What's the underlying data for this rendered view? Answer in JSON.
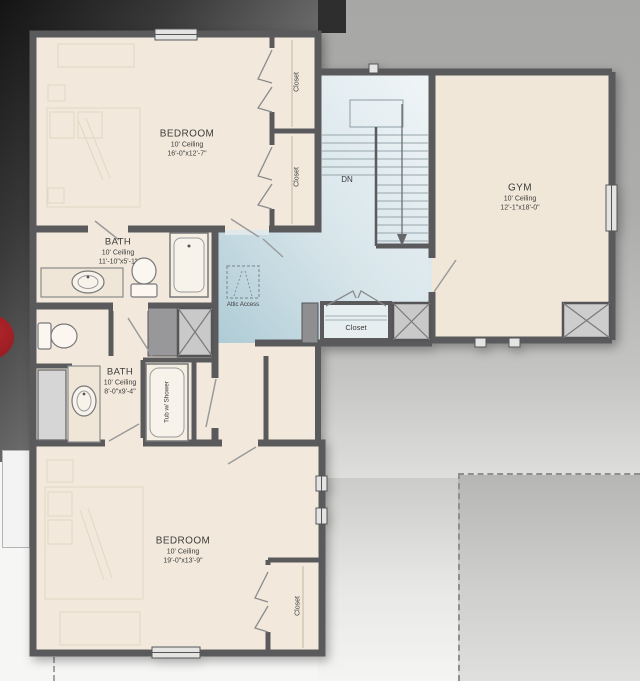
{
  "floorplan": {
    "rooms": {
      "bedroom_top": {
        "name": "BEDROOM",
        "ceiling": "10' Ceiling",
        "dims": "16'-0\"x12'-7\""
      },
      "bath_top": {
        "name": "BATH",
        "ceiling": "10' Ceiling",
        "dims": "11'-10\"x5'-1\""
      },
      "bath_bottom": {
        "name": "BATH",
        "ceiling": "10' Ceiling",
        "dims": "8'-0\"x9'-4\""
      },
      "bedroom_bottom": {
        "name": "BEDROOM",
        "ceiling": "10' Ceiling",
        "dims": "19'-0\"x13'-9\""
      },
      "gym": {
        "name": "GYM",
        "ceiling": "10' Ceiling",
        "dims": "12'-1\"x18'-0\""
      }
    },
    "labels": {
      "closet": "Closet",
      "stairs_down": "DN",
      "attic_access": "Attic Access",
      "tub_shower": "Tub w/ Shower"
    },
    "colors": {
      "floor_beige": "#f2e9dc",
      "hall_blue_light": "#eef4f6",
      "hall_blue_dark": "#aecbd5",
      "wall_gray": "#5a5a5c",
      "accent_red": "#a32126"
    }
  }
}
